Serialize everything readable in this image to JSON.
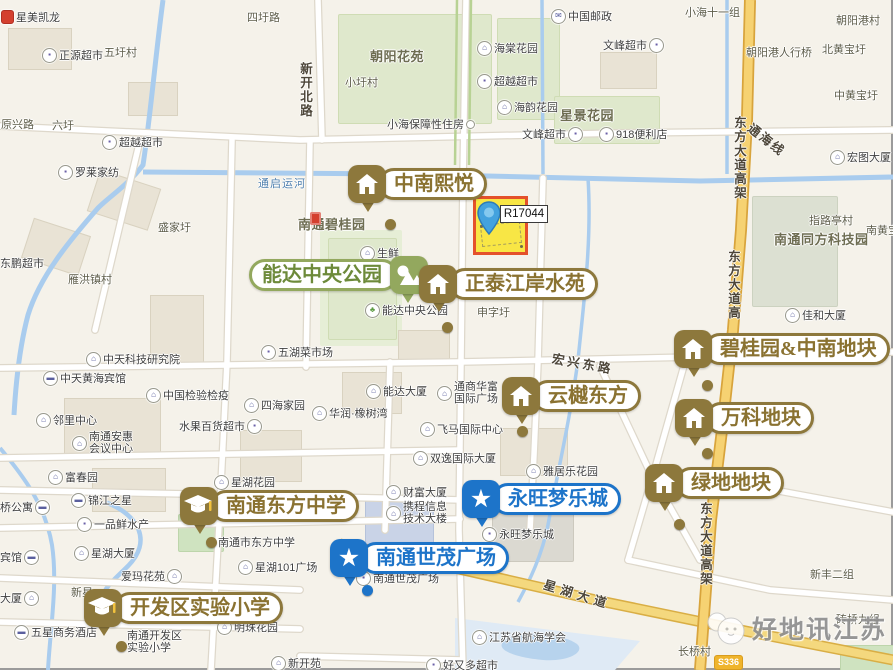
{
  "map": {
    "parcel_label": "R17044",
    "road_shield": "S336",
    "watermark": "好地讯江苏",
    "callouts": [
      {
        "id": "zhongnan-xiyue",
        "label": "中南熙悦",
        "type": "house",
        "color": "gold",
        "x": 348,
        "y": 165,
        "dot": [
          385,
          219
        ]
      },
      {
        "id": "nengda-central-park",
        "label": "能达中央公园",
        "type": "park",
        "color": "green",
        "x": 249,
        "y": 256,
        "badge_side": "right",
        "dot": null
      },
      {
        "id": "zhengtai-jiangan-shuiyuan",
        "label": "正泰江岸水苑",
        "type": "house",
        "color": "gold",
        "x": 419,
        "y": 265,
        "dot": [
          442,
          322
        ]
      },
      {
        "id": "yunyue-dongfang",
        "label": "云樾东方",
        "type": "house",
        "color": "gold",
        "x": 502,
        "y": 377,
        "dot": [
          517,
          426
        ]
      },
      {
        "id": "biguiyuan-zhongnan-dikuai",
        "label": "碧桂园&中南地块",
        "type": "house",
        "color": "gold",
        "x": 674,
        "y": 330,
        "dot": [
          702,
          380
        ]
      },
      {
        "id": "wanke-dikuai",
        "label": "万科地块",
        "type": "house",
        "color": "gold",
        "x": 675,
        "y": 399,
        "dot": [
          702,
          448
        ]
      },
      {
        "id": "lvdi-dikuai",
        "label": "绿地地块",
        "type": "house",
        "color": "gold",
        "x": 645,
        "y": 464,
        "dot": [
          674,
          519
        ]
      },
      {
        "id": "yongwang-mengle-cheng",
        "label": "永旺梦乐城",
        "type": "star",
        "color": "blue",
        "x": 462,
        "y": 480,
        "dot": null
      },
      {
        "id": "nantong-shimao-guangchang",
        "label": "南通世茂广场",
        "type": "star",
        "color": "blue",
        "x": 330,
        "y": 539,
        "dot": [
          362,
          585
        ]
      },
      {
        "id": "nantong-dongfang-zhongxue",
        "label": "南通东方中学",
        "type": "school",
        "color": "gold",
        "x": 180,
        "y": 487,
        "dot": [
          206,
          537
        ]
      },
      {
        "id": "kaifaqu-shiyan-xiaoxue",
        "label": "开发区实验小学",
        "type": "school",
        "color": "gold",
        "x": 84,
        "y": 589,
        "dot": [
          116,
          641
        ]
      }
    ],
    "areas": [
      {
        "x": 370,
        "y": 46,
        "text": "朝阳花苑"
      },
      {
        "x": 560,
        "y": 105,
        "text": "星景花园"
      },
      {
        "x": 298,
        "y": 214,
        "text": "南通碧桂园",
        "red": true
      },
      {
        "x": 774,
        "y": 229,
        "text": "南通同方科技园"
      }
    ],
    "road_labels": [
      {
        "x": 300,
        "y": 62,
        "text": "新开北路",
        "vertical": true
      },
      {
        "x": 734,
        "y": 116,
        "text": "东方大道高架",
        "vertical": true
      },
      {
        "x": 728,
        "y": 250,
        "text": "东方大道高",
        "vertical": true
      },
      {
        "x": 700,
        "y": 502,
        "text": "东方大道高架",
        "vertical": true
      },
      {
        "x": 756,
        "y": 118,
        "text": "通海线",
        "rotate": 38,
        "ls": 2
      },
      {
        "x": 554,
        "y": 348,
        "text": "宏兴东路",
        "rotate": 10,
        "ls": 3
      },
      {
        "x": 547,
        "y": 574,
        "text": "星湖大道",
        "rotate": 17,
        "ls": 5
      },
      {
        "x": 258,
        "y": 175,
        "text": "通启运河",
        "cls": "river"
      }
    ],
    "pois": [
      {
        "x": 1,
        "y": 9,
        "icon": "red",
        "text": "星美凯龙"
      },
      {
        "x": 42,
        "y": 47,
        "icon": "shop",
        "text": "正源超市"
      },
      {
        "x": 104,
        "y": 44,
        "text": "五圩村",
        "cls": "vil"
      },
      {
        "x": 247,
        "y": 9,
        "text": "四圩路",
        "cls": "vil"
      },
      {
        "x": 1,
        "y": 116,
        "text": "原兴路",
        "cls": "vil"
      },
      {
        "x": 52,
        "y": 117,
        "text": "六圩",
        "cls": "vil"
      },
      {
        "x": 102,
        "y": 134,
        "icon": "shop",
        "text": "超越超市"
      },
      {
        "x": 345,
        "y": 74,
        "text": "小圩村",
        "cls": "vil"
      },
      {
        "x": 477,
        "y": 40,
        "icon": "building",
        "text": "海棠花园"
      },
      {
        "x": 477,
        "y": 73,
        "icon": "shop",
        "text": "超越超市"
      },
      {
        "x": 497,
        "y": 99,
        "icon": "building",
        "text": "海韵花园"
      },
      {
        "x": 387,
        "y": 116,
        "text": "小海保障性住房",
        "icon_after": "dot"
      },
      {
        "x": 522,
        "y": 126,
        "text": "文峰超市",
        "icon_after": "shop"
      },
      {
        "x": 599,
        "y": 126,
        "icon": "shop",
        "text": "918便利店"
      },
      {
        "x": 551,
        "y": 8,
        "icon": "mail",
        "text": "中国邮政"
      },
      {
        "x": 685,
        "y": 4,
        "text": "小海十一组",
        "cls": "vil"
      },
      {
        "x": 836,
        "y": 12,
        "text": "朝阳港村",
        "cls": "vil"
      },
      {
        "x": 603,
        "y": 37,
        "text": "文峰超市",
        "icon_after": "shop"
      },
      {
        "x": 746,
        "y": 44,
        "text": "朝阳港人行桥",
        "cls": "vil"
      },
      {
        "x": 822,
        "y": 41,
        "text": "北黄宝圩",
        "cls": "vil"
      },
      {
        "x": 834,
        "y": 87,
        "text": "中黄宝圩",
        "cls": "vil"
      },
      {
        "x": 830,
        "y": 149,
        "icon": "building",
        "text": "宏图大厦"
      },
      {
        "x": 809,
        "y": 212,
        "text": "指路亭村",
        "cls": "vil"
      },
      {
        "x": 866,
        "y": 222,
        "text": "南黄宝圩",
        "cls": "vil"
      },
      {
        "x": 785,
        "y": 307,
        "icon": "building",
        "text": "佳和大厦"
      },
      {
        "x": 58,
        "y": 164,
        "icon": "shop",
        "text": "罗莱家纺"
      },
      {
        "x": 158,
        "y": 219,
        "text": "盛家圩",
        "cls": "vil"
      },
      {
        "x": 0,
        "y": 255,
        "text": "东鹏超市"
      },
      {
        "x": 68,
        "y": 271,
        "text": "雁洪镇村",
        "cls": "vil"
      },
      {
        "x": 360,
        "y": 245,
        "icon": "building",
        "text": "生鲜"
      },
      {
        "x": 365,
        "y": 302,
        "icon": "park",
        "text": "能达中央公园"
      },
      {
        "x": 477,
        "y": 304,
        "text": "申字圩",
        "cls": "vil"
      },
      {
        "x": 86,
        "y": 351,
        "icon": "building",
        "text": "中天科技研究院"
      },
      {
        "x": 43,
        "y": 370,
        "icon": "hotel",
        "text": "中天黄海宾馆"
      },
      {
        "x": 146,
        "y": 387,
        "icon": "building",
        "text": "中国检验检疫"
      },
      {
        "x": 36,
        "y": 412,
        "icon": "building",
        "text": "邻里中心"
      },
      {
        "x": 72,
        "y": 432,
        "icon": "building",
        "lines": [
          "南通安惠",
          "会议中心"
        ]
      },
      {
        "x": 48,
        "y": 469,
        "icon": "building",
        "text": "富春园"
      },
      {
        "x": 214,
        "y": 474,
        "icon": "building",
        "text": "星湖花园"
      },
      {
        "x": 244,
        "y": 397,
        "icon": "building",
        "text": "四海家园"
      },
      {
        "x": 179,
        "y": 418,
        "text": "水果百货超市",
        "icon_after": "shop"
      },
      {
        "x": 261,
        "y": 344,
        "icon": "shop",
        "text": "五湖菜市场"
      },
      {
        "x": 366,
        "y": 383,
        "icon": "building",
        "text": "能达大厦"
      },
      {
        "x": 312,
        "y": 405,
        "icon": "building",
        "text": "华润·橡树湾"
      },
      {
        "x": 437,
        "y": 382,
        "icon": "building",
        "lines": [
          "通商华富",
          "国际广场"
        ]
      },
      {
        "x": 420,
        "y": 421,
        "icon": "building",
        "text": "飞马国际中心"
      },
      {
        "x": 413,
        "y": 450,
        "icon": "building",
        "text": "双逸国际大厦"
      },
      {
        "x": 386,
        "y": 484,
        "icon": "building",
        "text": "财富大厦"
      },
      {
        "x": 526,
        "y": 463,
        "icon": "building",
        "text": "雅居乐花园"
      },
      {
        "x": 386,
        "y": 502,
        "icon": "building",
        "lines": [
          "携程信息",
          "技术大楼"
        ]
      },
      {
        "x": 482,
        "y": 526,
        "icon": "shop",
        "text": "永旺梦乐城"
      },
      {
        "x": 356,
        "y": 570,
        "icon": "shop",
        "text": "南通世茂广场"
      },
      {
        "x": 472,
        "y": 629,
        "icon": "building",
        "text": "江苏省航海学会"
      },
      {
        "x": 426,
        "y": 657,
        "icon": "shop",
        "text": "好又多超市"
      },
      {
        "x": 271,
        "y": 655,
        "icon": "building",
        "text": "新开苑"
      },
      {
        "x": 71,
        "y": 492,
        "icon": "hotel",
        "text": "锦江之星"
      },
      {
        "x": 0,
        "y": 499,
        "text": "桥公寓",
        "icon_after": "hotel"
      },
      {
        "x": 77,
        "y": 516,
        "icon": "shop",
        "text": "一品鲜水产"
      },
      {
        "x": 74,
        "y": 545,
        "icon": "building",
        "text": "星湖大厦"
      },
      {
        "x": 0,
        "y": 549,
        "text": "宾馆",
        "icon_after": "hotel"
      },
      {
        "x": 121,
        "y": 568,
        "text": "爱玛花苑",
        "icon_after": "building"
      },
      {
        "x": 71,
        "y": 584,
        "text": "新星",
        "cls": "vil"
      },
      {
        "x": 0,
        "y": 590,
        "text": "大厦",
        "icon_after": "building"
      },
      {
        "x": 14,
        "y": 624,
        "icon": "hotel",
        "text": "五星商务酒店"
      },
      {
        "x": 217,
        "y": 619,
        "icon": "building",
        "text": "明珠花园"
      },
      {
        "x": 238,
        "y": 559,
        "icon": "building",
        "text": "星湖101广场"
      },
      {
        "x": 218,
        "y": 534,
        "text": "南通市东方中学"
      },
      {
        "x": 127,
        "y": 631,
        "lines": [
          "南通开发区",
          "实验小学"
        ]
      },
      {
        "x": 678,
        "y": 643,
        "text": "长桥村",
        "cls": "vil"
      },
      {
        "x": 810,
        "y": 566,
        "text": "新丰二组",
        "cls": "vil"
      },
      {
        "x": 836,
        "y": 611,
        "text": "砖桥九组",
        "cls": "vil"
      }
    ]
  }
}
